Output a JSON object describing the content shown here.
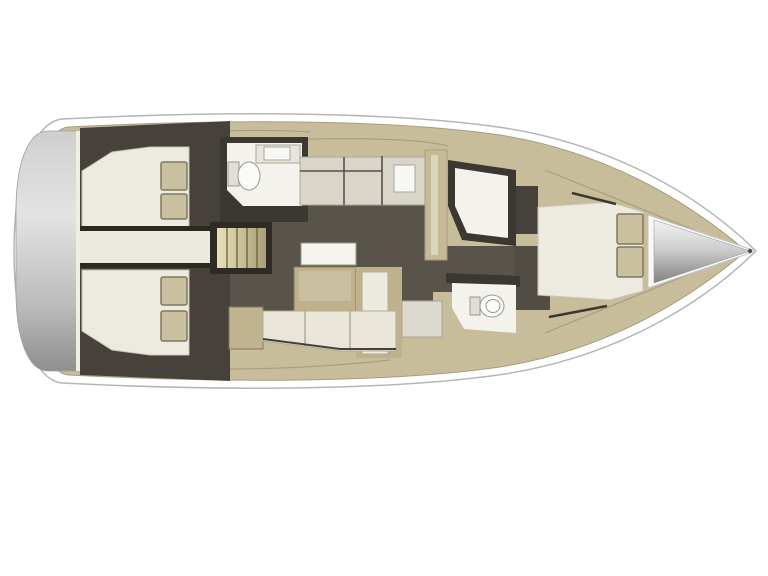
{
  "meta": {
    "description": "Top-down interior layout plan of a sailing yacht, bow pointing right",
    "background": "#ffffff"
  },
  "colors": {
    "hull_fill": "#ffffff",
    "hull_stroke": "#b5b5b5",
    "deck": "#c8bd9b",
    "deck_stroke": "#a79d7e",
    "deck_line": "#a89e7f",
    "separator": "#efede4",
    "transom_top": "#cfcfcf",
    "transom_hi": "#e3e3e3",
    "transom_low": "#bcbcbc",
    "transom_bottom": "#8f8f8f",
    "dark": "#46423b",
    "dark_frame": "#2e2b25",
    "bath_wall": "#3b3832",
    "floor": "#58534b",
    "floor_fwd": "#514c44",
    "cream": "#edeae0",
    "cream_stroke": "#c9c3b2",
    "pillow": "#c8c09e",
    "pillow_stroke": "#7f795e",
    "engine": "#eceadf",
    "engine_line": "#2c2923",
    "stair_light": "#e9e1b5",
    "stair_dark": "#a99e79",
    "stair_line": "#6e6549",
    "counter": "#d9d5c9",
    "counter_line": "#55514a",
    "white_fixture": "#f7f7f4",
    "bath_white": "#f3f2ed",
    "toilet": "#fbfbf9",
    "toilet_stroke": "#9a988e",
    "tank": "#e0ded5",
    "pillar": "#c5ba95",
    "pillar_inner": "#dcd5bd",
    "table": "#f4f3ee",
    "table_stroke": "#9c978b",
    "bench": "#bfb28b",
    "bench_inner": "#cabfa0",
    "leaf_cream": "#eceade",
    "settee": "#e9e6d9",
    "settee_stroke": "#b2ab94",
    "settee_dark_line": "#45413a",
    "cabinet": "#c0b490",
    "seat": "#dcd9d0",
    "seat_stroke": "#a9a59a",
    "bow_under": "#f8f8f6",
    "bow_under_stroke": "#c4c4c4",
    "cone_top": "#f4f4f4",
    "cone_mid": "#cfcfcf",
    "cone_bottom": "#828282",
    "cone_stroke": "#9b9b9b",
    "cone_tip": "#4f4f4f",
    "dash": "#3c392f",
    "sink_tray": "#e6e4dc",
    "sink_tray_stroke": "#a9a69a"
  }
}
